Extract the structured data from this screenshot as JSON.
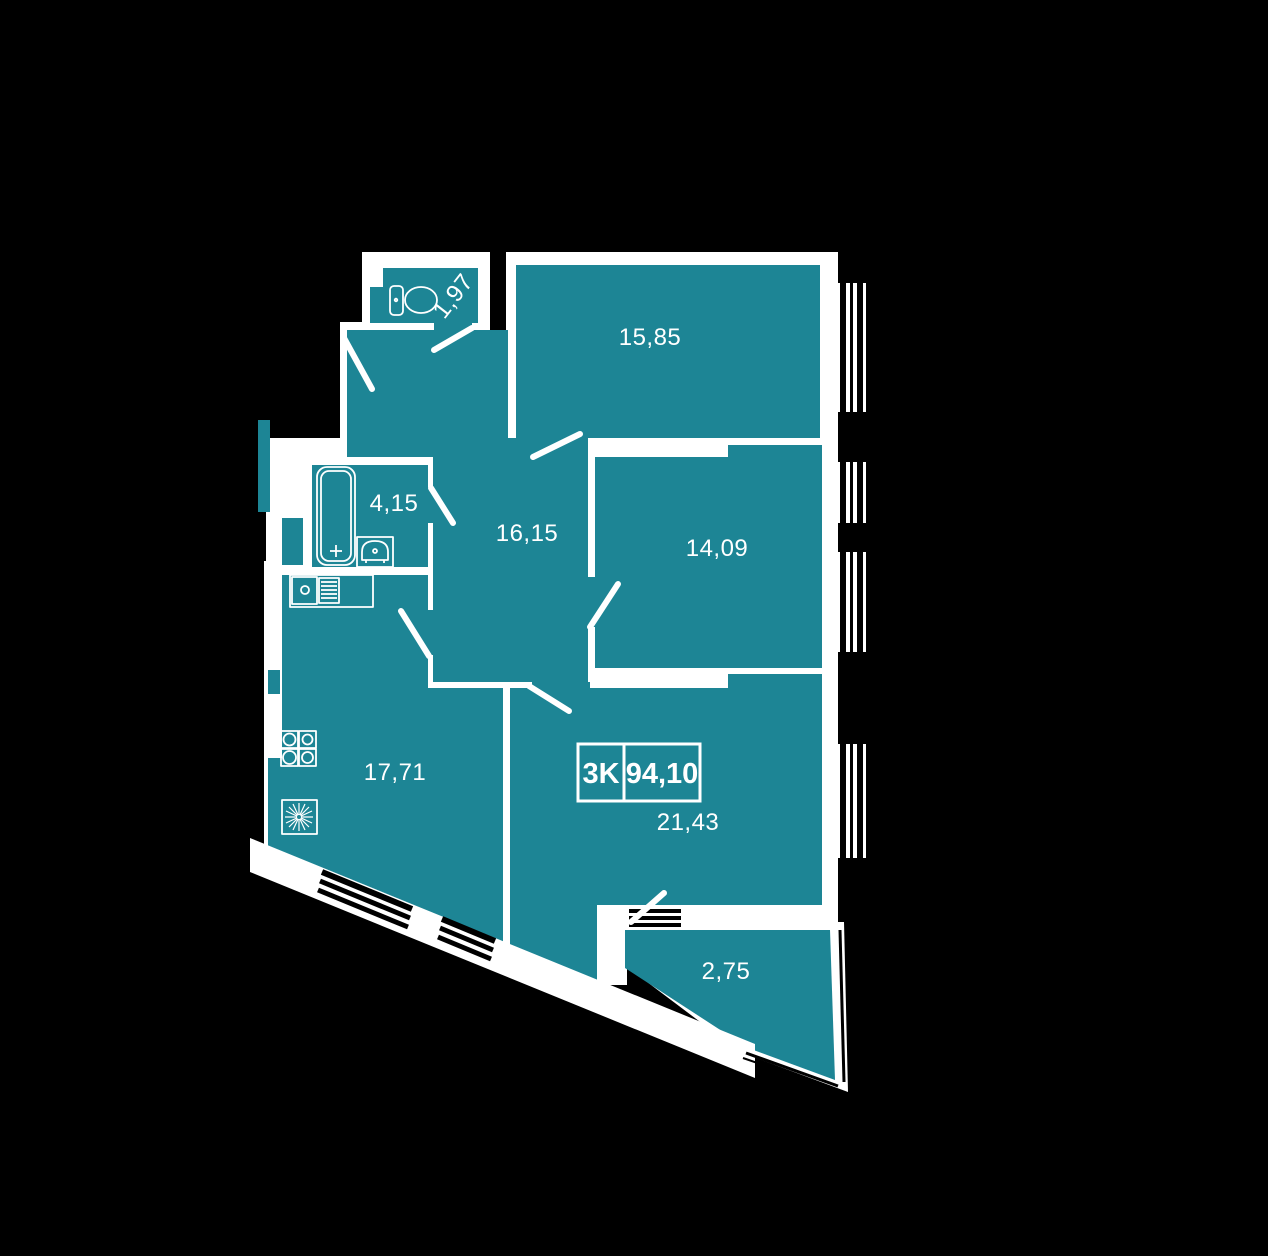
{
  "plan": {
    "title": "apartment-floor-plan",
    "unit_badge": {
      "rooms_label": "3K",
      "area_label": "94,10"
    },
    "rooms": [
      {
        "id": "wc",
        "area": "1,97"
      },
      {
        "id": "bedroom-1",
        "area": "15,85"
      },
      {
        "id": "bathroom",
        "area": "4,15"
      },
      {
        "id": "hallway",
        "area": "16,15"
      },
      {
        "id": "bedroom-2",
        "area": "14,09"
      },
      {
        "id": "kitchen",
        "area": "17,71"
      },
      {
        "id": "living-room",
        "area": "21,43"
      },
      {
        "id": "balcony",
        "area": "2,75"
      }
    ],
    "colors": {
      "background": "#000000",
      "room_fill": "#1d8595",
      "walls": "#ffffff",
      "text": "#ffffff"
    }
  }
}
